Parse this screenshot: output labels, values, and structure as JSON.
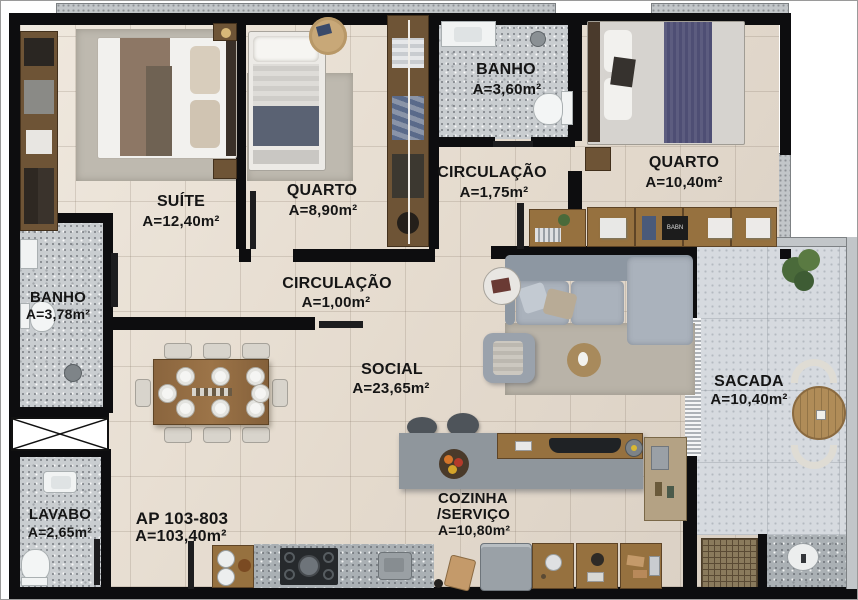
{
  "plan_title": "apartment floor plan",
  "rooms": {
    "suite": {
      "name": "SUÍTE",
      "area": "A=12,40m²"
    },
    "quarto1": {
      "name": "QUARTO",
      "area": "A=8,90m²"
    },
    "banho1": {
      "name": "BANHO",
      "area": "A=3,60m²"
    },
    "circulacao1": {
      "name": "CIRCULAÇÃO",
      "area": "A=1,75m²"
    },
    "quarto2": {
      "name": "QUARTO",
      "area": "A=10,40m²"
    },
    "banho2": {
      "name": "BANHO",
      "area": "A=3,78m²"
    },
    "circulacao2": {
      "name": "CIRCULAÇÃO",
      "area": "A=1,00m²"
    },
    "social": {
      "name": "SOCIAL",
      "area": "A=23,65m²"
    },
    "sacada": {
      "name": "SACADA",
      "area": "A=10,40m²"
    },
    "lavabo": {
      "name": "LAVABO",
      "area": "A=2,65m²"
    },
    "cozinha": {
      "name_line1": "COZINHA",
      "name_line2": "/SERVIÇO",
      "area": "A=10,80m²"
    }
  },
  "apartment": {
    "label": "AP 103-803",
    "area": "A=103,40m²"
  },
  "colors": {
    "wall": "#0d0d0f",
    "floor_tile": "#e4dacd",
    "bath_granite": "#c9cdd0",
    "balcony_floor": "#d6dadf",
    "wood": "#96713f",
    "wood_dark": "#6e5436",
    "sofa_gray": "#9aa3ad",
    "bed_navy": "#4e4e74",
    "bed_brown": "#8d7765",
    "label_text": "#151515"
  }
}
